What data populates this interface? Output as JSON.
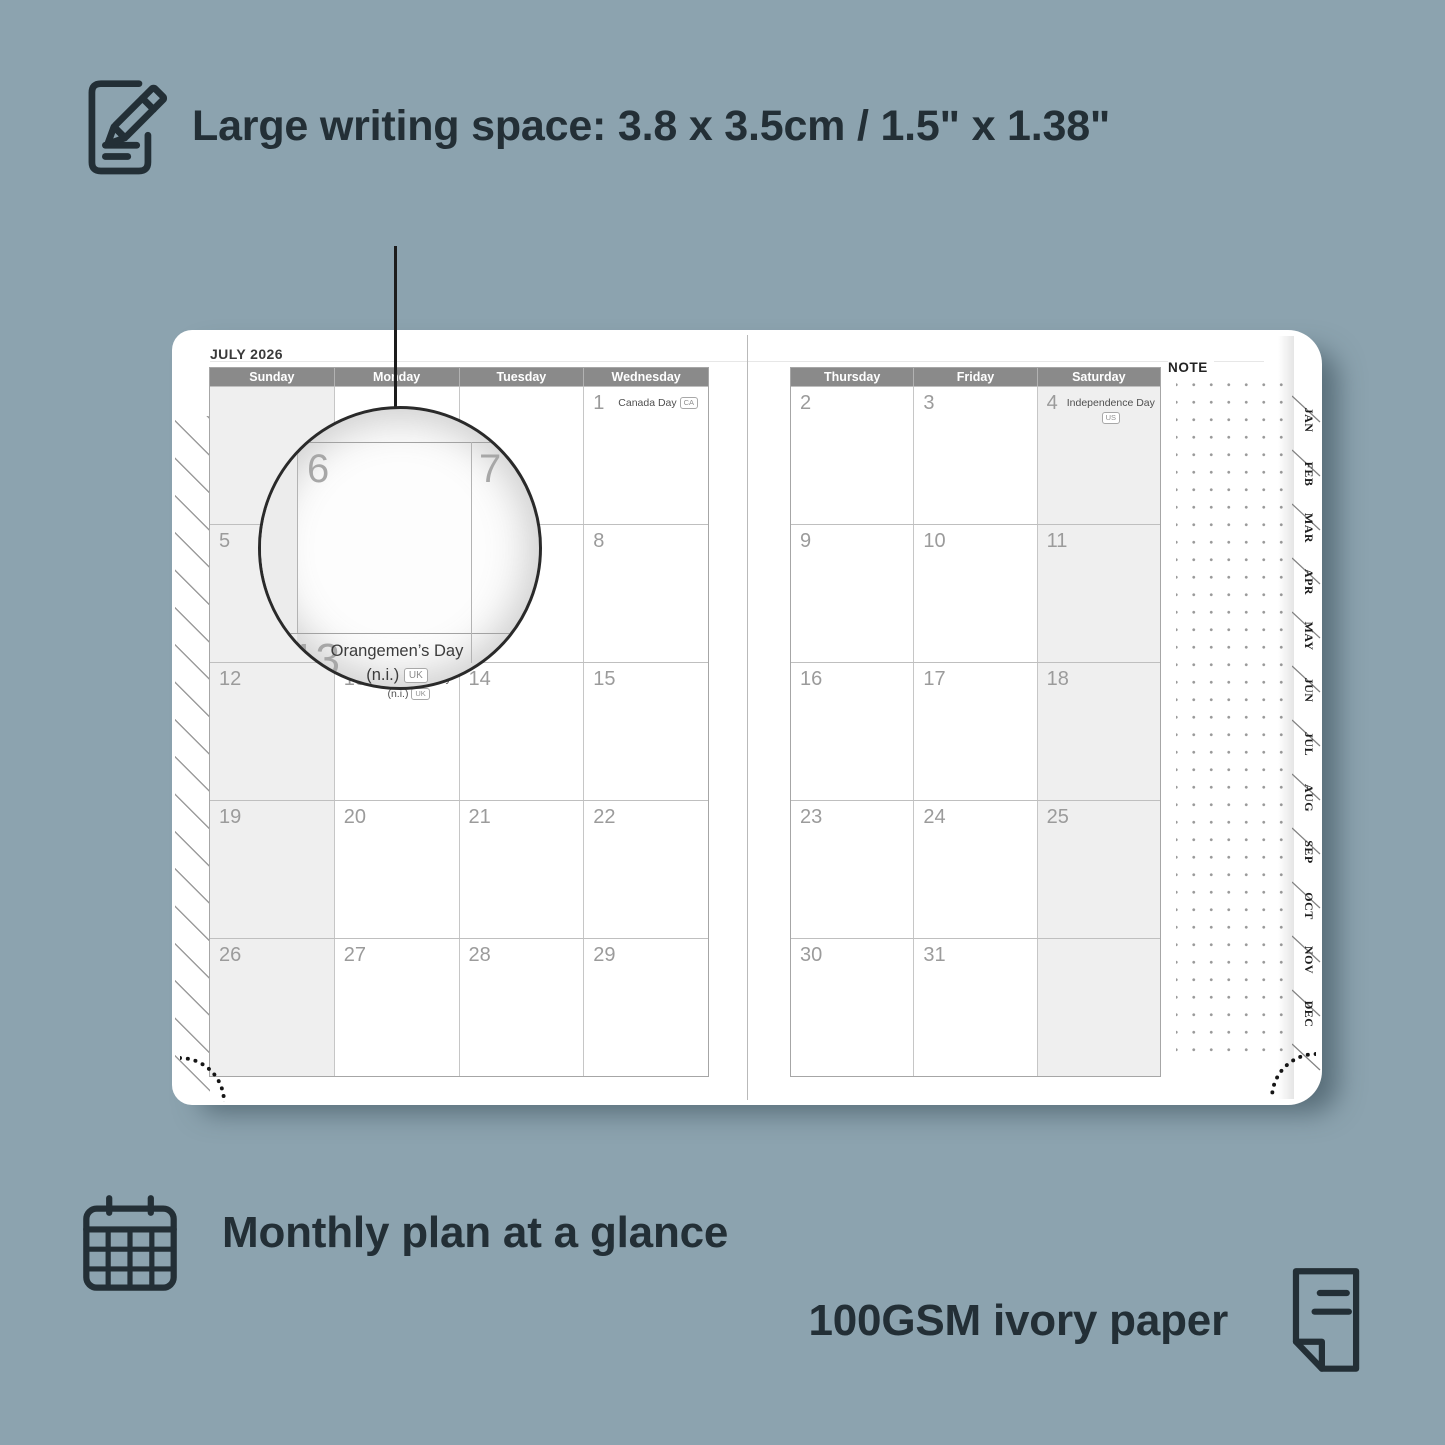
{
  "top_feature": {
    "icon": "notepad-pencil-icon",
    "label": "Large writing space: 3.8 x 3.5cm / 1.5\" x 1.38\""
  },
  "bottom_features": [
    {
      "icon": "calendar-grid-icon",
      "label": "Monthly plan at a glance"
    },
    {
      "icon": "paper-sheet-icon",
      "label": "100GSM ivory paper"
    }
  ],
  "planner": {
    "month_title": "JULY 2026",
    "note_label": "NOTE",
    "left_page_headers": [
      "Sunday",
      "Monday",
      "Tuesday",
      "Wednesday"
    ],
    "right_page_headers": [
      "Thursday",
      "Friday",
      "Saturday"
    ],
    "month_tabs": [
      "JAN",
      "FEB",
      "MAR",
      "APR",
      "MAY",
      "JUN",
      "JUL",
      "AUG",
      "SEP",
      "OCT",
      "NOV",
      "DEC"
    ],
    "left_page_rows": [
      [
        {
          "day": ""
        },
        {
          "day": ""
        },
        {
          "day": ""
        },
        {
          "day": "1",
          "holiday": "Canada Day",
          "badge": "CA"
        }
      ],
      [
        {
          "day": "5"
        },
        {
          "day": "6"
        },
        {
          "day": "7"
        },
        {
          "day": "8"
        }
      ],
      [
        {
          "day": "12"
        },
        {
          "day": "13",
          "holiday": "Orangemen’s Day",
          "holiday2": "(n.i.)",
          "badge": "UK"
        },
        {
          "day": "14"
        },
        {
          "day": "15"
        }
      ],
      [
        {
          "day": "19"
        },
        {
          "day": "20"
        },
        {
          "day": "21"
        },
        {
          "day": "22"
        }
      ],
      [
        {
          "day": "26"
        },
        {
          "day": "27"
        },
        {
          "day": "28"
        },
        {
          "day": "29"
        }
      ]
    ],
    "right_page_rows": [
      [
        {
          "day": "2"
        },
        {
          "day": "3"
        },
        {
          "day": "4",
          "holiday": "Independence Day",
          "badge": "US"
        }
      ],
      [
        {
          "day": "9"
        },
        {
          "day": "10"
        },
        {
          "day": "11"
        }
      ],
      [
        {
          "day": "16"
        },
        {
          "day": "17"
        },
        {
          "day": "18"
        }
      ],
      [
        {
          "day": "23"
        },
        {
          "day": "24"
        },
        {
          "day": "25"
        }
      ],
      [
        {
          "day": "30"
        },
        {
          "day": "31"
        },
        {
          "day": ""
        }
      ]
    ]
  },
  "magnifier": {
    "zoom_days": {
      "main": "6",
      "right": "7",
      "below": "13"
    },
    "holiday_line1": "Orangemen’s Day",
    "holiday_line2": "(n.i.)",
    "holiday_badge": "UK"
  },
  "colors": {
    "background": "#8ca3af",
    "ink": "#232f36",
    "header_bar": "#8a8a8a",
    "weekend_shade": "#efefef",
    "page": "#ffffff",
    "day_number": "#9b9b9b"
  }
}
